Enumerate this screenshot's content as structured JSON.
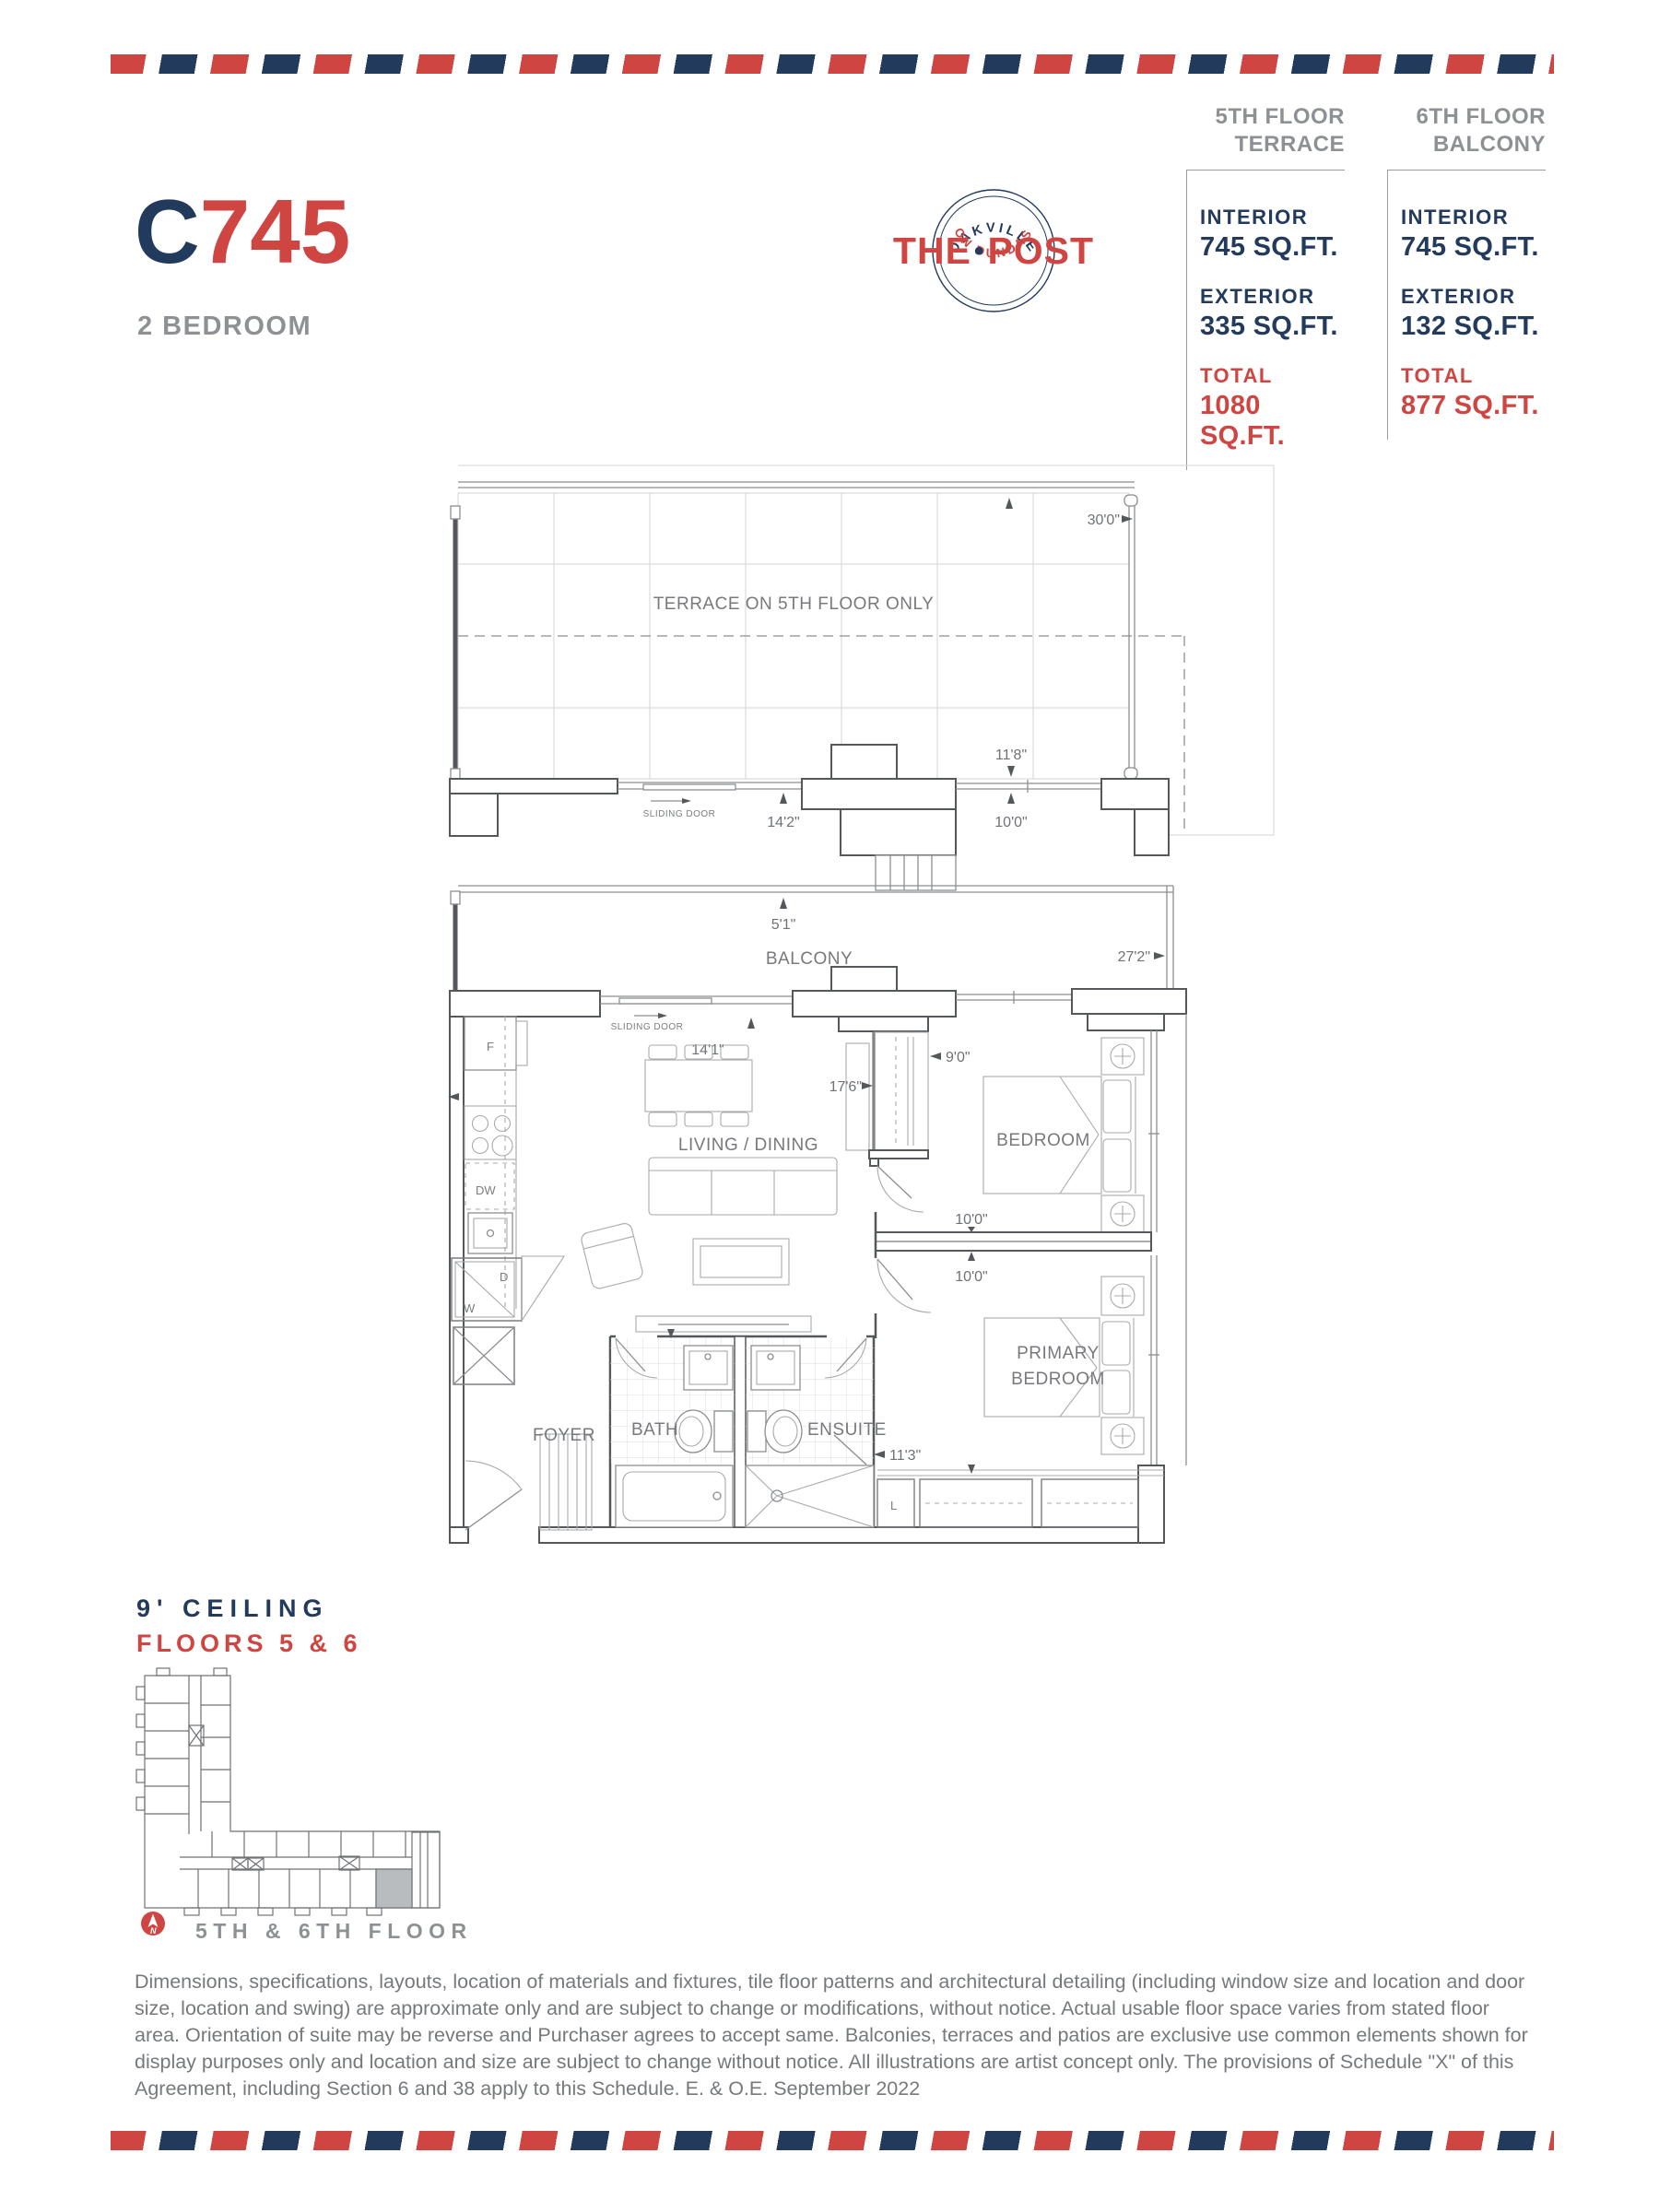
{
  "colors": {
    "red": "#cf4541",
    "navy": "#223a5c",
    "gray": "#8e9194"
  },
  "header": {
    "unit_letter": "C",
    "unit_number": "745",
    "unit_type": "2 BEDROOM"
  },
  "logo": {
    "arc_top": "OAKVILLE",
    "word_left": "THE",
    "dot": "•",
    "word_right": "POST",
    "arc_bottom": "ON DUNDAS"
  },
  "stats": {
    "columns": [
      {
        "floor": "5TH FLOOR",
        "location": "TERRACE",
        "interior_label": "INTERIOR",
        "interior_value": "745 SQ.FT.",
        "exterior_label": "EXTERIOR",
        "exterior_value": "335 SQ.FT.",
        "total_label": "TOTAL",
        "total_value": "1080 SQ.FT."
      },
      {
        "floor": "6TH FLOOR",
        "location": "BALCONY",
        "interior_label": "INTERIOR",
        "interior_value": "745 SQ.FT.",
        "exterior_label": "EXTERIOR",
        "exterior_value": "132 SQ.FT.",
        "total_label": "TOTAL",
        "total_value": "877 SQ.FT."
      }
    ]
  },
  "terrace_plan": {
    "area_label": "TERRACE ON 5TH FLOOR ONLY",
    "dim_width": "30'0\"",
    "sliding_door": "SLIDING DOOR",
    "dim_door": "14'2\"",
    "dim_depth_a": "11'8\"",
    "dim_depth_b": "10'0\""
  },
  "floor_plan": {
    "balcony_label": "BALCONY",
    "dim_balcony_depth": "5'1\"",
    "dim_balcony_width": "27'2\"",
    "sliding_door": "SLIDING DOOR",
    "dim_slider": "14'1\"",
    "living_label": "LIVING / DINING",
    "dim_living": "17'6\"",
    "dim_closet": "9'0\"",
    "bedroom_label": "BEDROOM",
    "dim_bedroom": "10'0\"",
    "dim_primary_width": "10'0\"",
    "primary_label_1": "PRIMARY",
    "primary_label_2": "BEDROOM",
    "dim_primary": "11'3\"",
    "bath_label": "BATH",
    "ensuite_label": "ENSUITE",
    "foyer_label": "FOYER",
    "fridge": "F",
    "dishwasher": "DW",
    "dryer": "D",
    "washer": "W",
    "linen": "L"
  },
  "ceiling": {
    "line1": "9' CEILING",
    "line2": "FLOORS 5 & 6"
  },
  "key_plan": {
    "caption": "5TH & 6TH FLOOR",
    "north_label": "N"
  },
  "disclaimer": "Dimensions, specifications, layouts, location of materials and fixtures, tile floor patterns and architectural detailing (including window size and location and door size, location and swing) are approximate only and are subject to change or modifications, without notice. Actual usable floor space varies from stated floor area. Orientation of suite may be reverse and Purchaser agrees to accept same. Balconies, terraces and patios are exclusive use common elements shown for display purposes only and location and size are subject to change without notice. All illustrations are artist concept only. The provisions of Schedule \"X\" of this Agreement, including Section 6 and 38 apply to this Schedule. E. & O.E. September 2022"
}
